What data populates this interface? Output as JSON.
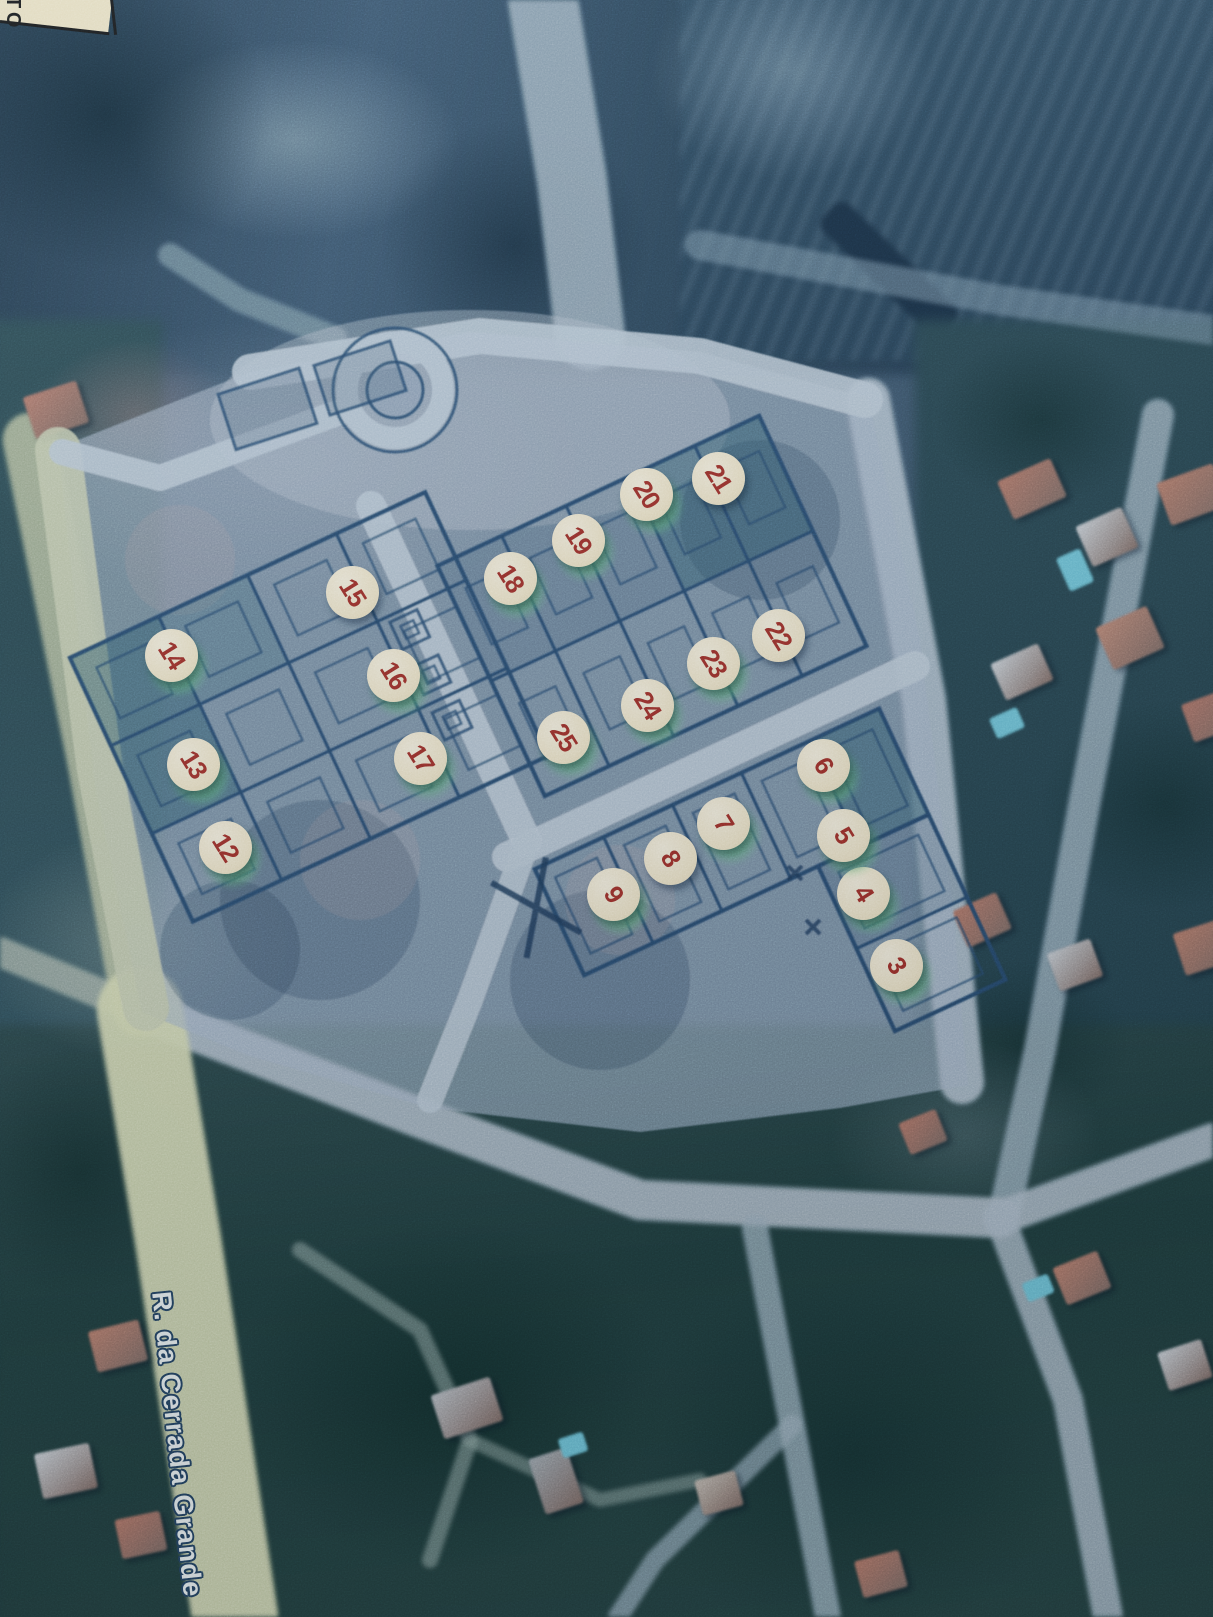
{
  "scene": {
    "type": "photographed printed aerial map with numbered lot plan overlay",
    "street_label": "R. da Cerrada Grande",
    "corner_label_fragment": "TO"
  },
  "colors": {
    "marker_background": "#f2e7c8",
    "marker_number": "#9e2d25",
    "green_highlight": "#6ecd82",
    "plan_ink": "#27496c",
    "plan_paper": "#a3b4c7",
    "yellow_road": "#d6dbb2",
    "street_label_text": "#eef4f3",
    "street_label_outline": "#24425f"
  },
  "markers": [
    {
      "label": "3",
      "x": 896,
      "y": 965,
      "green": true
    },
    {
      "label": "4",
      "x": 863,
      "y": 893,
      "green": true
    },
    {
      "label": "5",
      "x": 843,
      "y": 835,
      "green": true
    },
    {
      "label": "6",
      "x": 823,
      "y": 765,
      "green": true
    },
    {
      "label": "7",
      "x": 723,
      "y": 823,
      "green": true
    },
    {
      "label": "8",
      "x": 670,
      "y": 858,
      "green": false
    },
    {
      "label": "9",
      "x": 613,
      "y": 894,
      "green": true
    },
    {
      "label": "12",
      "x": 225,
      "y": 847,
      "green": true
    },
    {
      "label": "13",
      "x": 193,
      "y": 764,
      "green": true
    },
    {
      "label": "14",
      "x": 171,
      "y": 655,
      "green": true
    },
    {
      "label": "15",
      "x": 352,
      "y": 592,
      "green": false
    },
    {
      "label": "16",
      "x": 393,
      "y": 675,
      "green": true
    },
    {
      "label": "17",
      "x": 420,
      "y": 758,
      "green": true
    },
    {
      "label": "18",
      "x": 510,
      "y": 578,
      "green": true
    },
    {
      "label": "19",
      "x": 578,
      "y": 540,
      "green": true
    },
    {
      "label": "20",
      "x": 646,
      "y": 494,
      "green": true
    },
    {
      "label": "21",
      "x": 718,
      "y": 478,
      "green": false
    },
    {
      "label": "22",
      "x": 778,
      "y": 635,
      "green": false
    },
    {
      "label": "23",
      "x": 713,
      "y": 663,
      "green": true
    },
    {
      "label": "24",
      "x": 647,
      "y": 705,
      "green": true
    },
    {
      "label": "25",
      "x": 563,
      "y": 737,
      "green": true
    }
  ]
}
